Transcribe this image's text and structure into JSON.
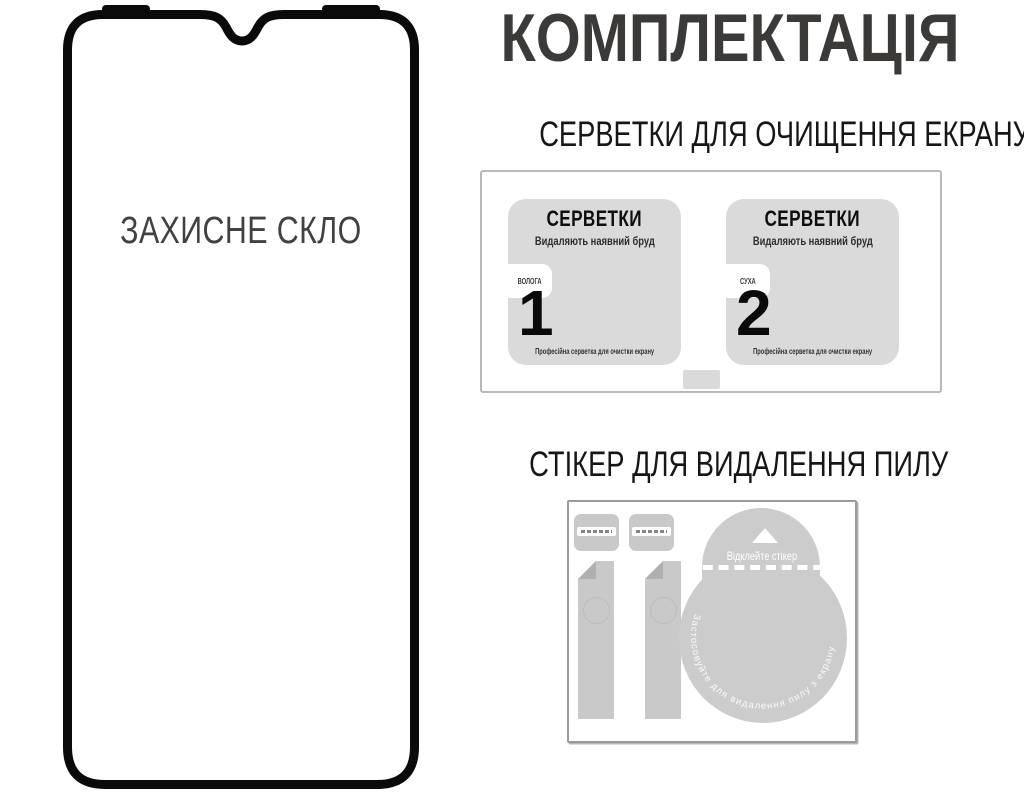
{
  "title": "КОМПЛЕКТАЦІЯ",
  "phone": {
    "label": "ЗАХИСНЕ СКЛО"
  },
  "wipes_section": {
    "header": "СЕРВЕТКИ ДЛЯ ОЧИЩЕННЯ ЕКРАНУ",
    "wipes": [
      {
        "name": "СЕРВЕТКИ",
        "subtitle": "Видаляють наявний бруд",
        "type_label": "ВОЛОГА",
        "number": "1",
        "footer": "Професійна серветка для очистки екрану"
      },
      {
        "name": "СЕРВЕТКИ",
        "subtitle": "Видаляють наявний бруд",
        "type_label": "СУХА",
        "number": "2",
        "footer": "Професійна серветка для очистки екрану"
      }
    ]
  },
  "sticker_section": {
    "header": "СТІКЕР ДЛЯ ВИДАЛЕННЯ ПИЛУ",
    "peel_label": "Відклейте стікер",
    "curved_label": "Застосовуйте для видалення пилу з екрану"
  },
  "colors": {
    "title_text": "#3b3a38",
    "header_text": "#161616",
    "phone_border": "#0a0a0a",
    "phone_label_text": "#414141",
    "wipe_fill": "#dadada",
    "sticker_fill": "#cbcbcb",
    "box_border": "#b9b9b9"
  }
}
